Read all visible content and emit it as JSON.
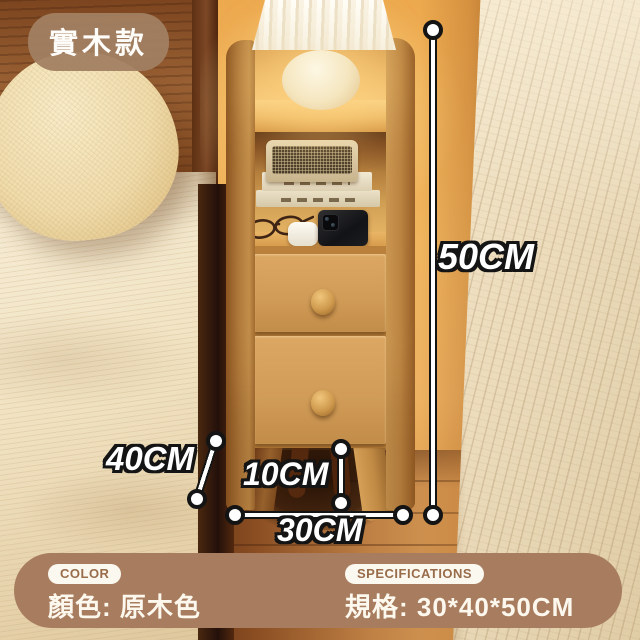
{
  "badge": {
    "label": "實木款",
    "bg_color": "#a28066"
  },
  "dimensions": {
    "height_label": "50CM",
    "depth_label": "40CM",
    "leg_height_label": "10CM",
    "width_label": "30CM"
  },
  "info_bar": {
    "bg_color": "#a87c5e",
    "color_tag": "COLOR",
    "color_value": "顏色: 原木色",
    "spec_tag": "SPECIFICATIONS",
    "spec_value": "規格: 30*40*50CM"
  },
  "scene_colors": {
    "wood_accent": "#d9a55c",
    "wall": "#edb262",
    "bedding": "#f1e3c2"
  }
}
